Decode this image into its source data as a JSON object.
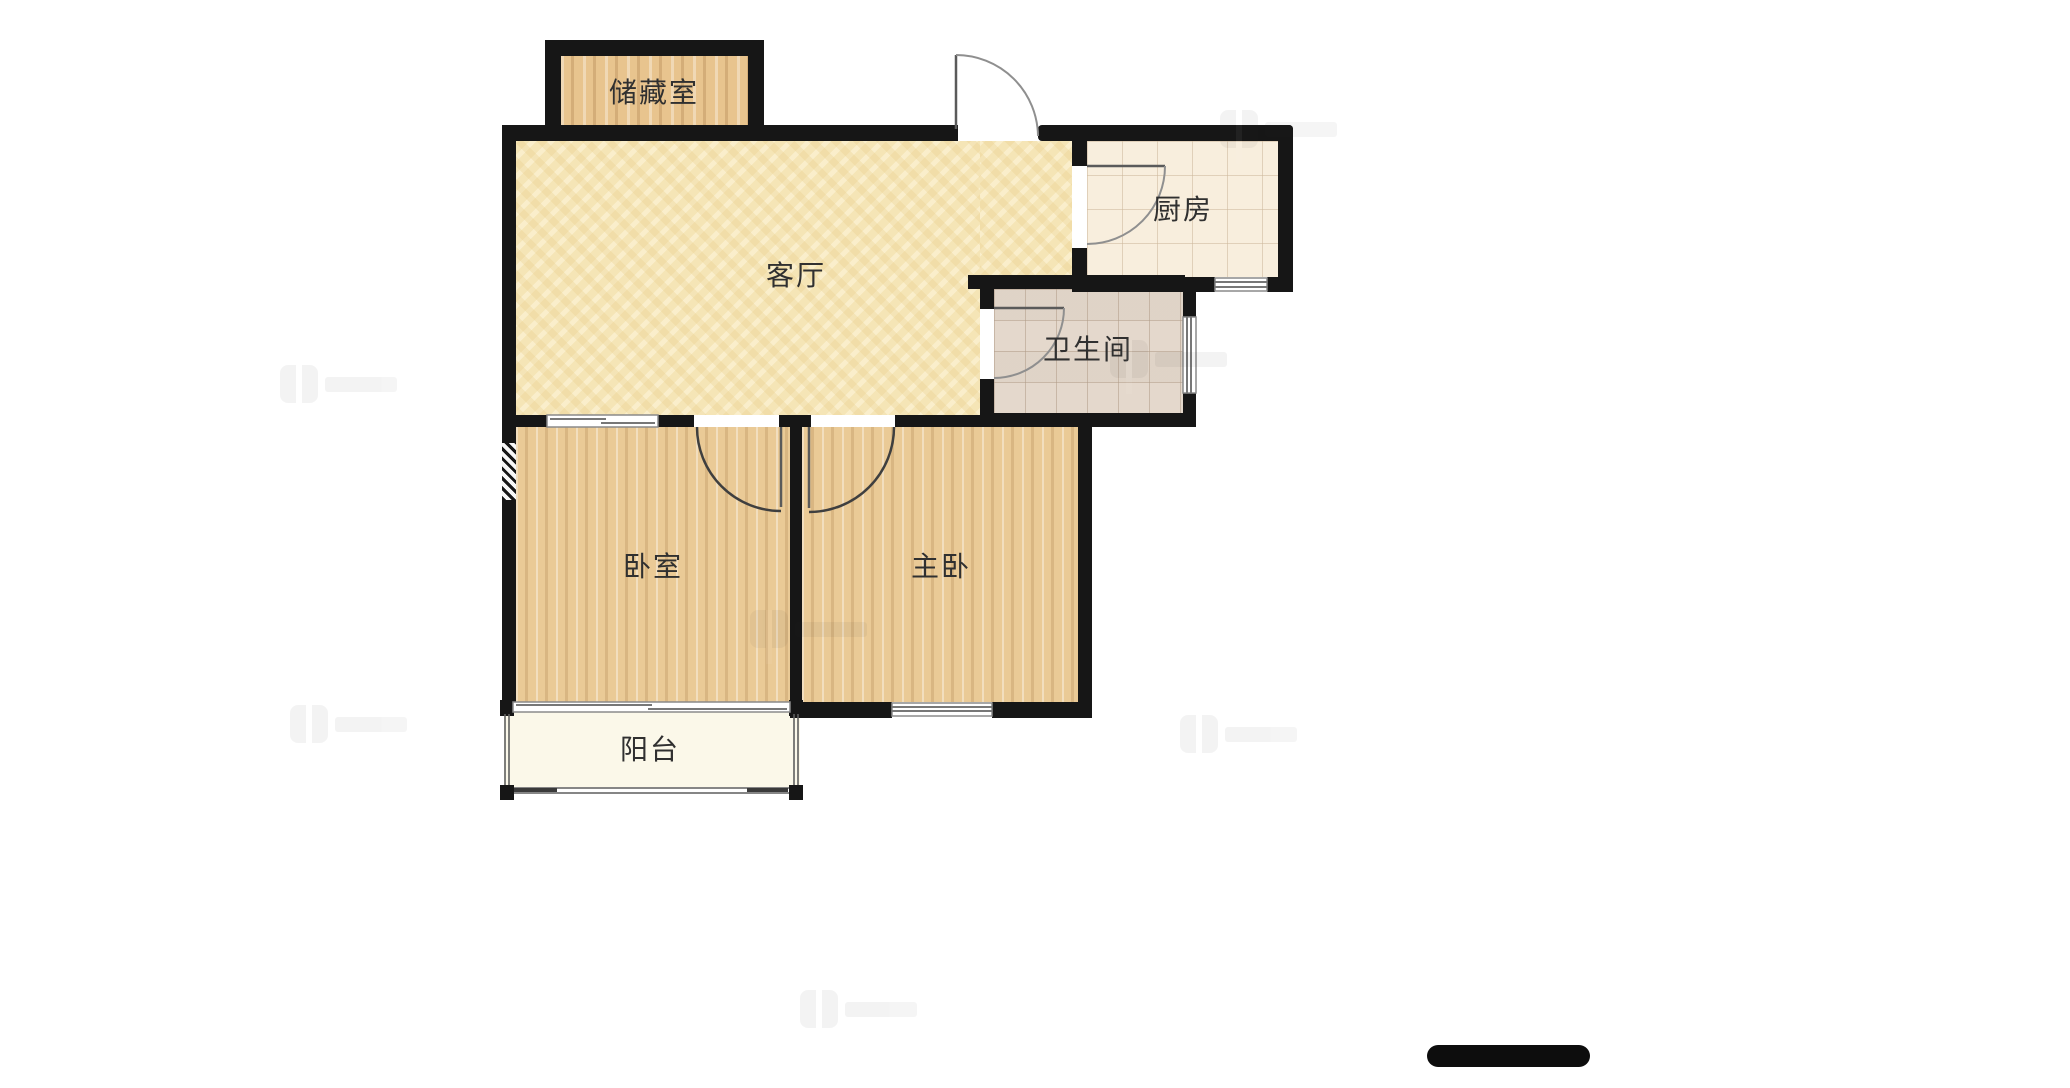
{
  "floor_plan": {
    "rooms": {
      "storage": {
        "label": "储藏室"
      },
      "living": {
        "label": "客厅"
      },
      "kitchen": {
        "label": "厨房"
      },
      "bathroom": {
        "label": "卫生间"
      },
      "bedroom": {
        "label": "卧室"
      },
      "master_bedroom": {
        "label": "主卧"
      },
      "balcony": {
        "label": "阳台"
      }
    },
    "colors": {
      "wall": "#161616",
      "living_floor": "#f5e5b6",
      "bedroom_wood_floor": "#eaca96",
      "storage_floor": "#e8c48e",
      "kitchen_tile_floor": "#f8eedd",
      "bathroom_tile_floor": "#ebe0d4",
      "balcony_floor": "#fbf8e9",
      "label_text": "#303030",
      "door_arc": "#8f8f8f",
      "window_symbol": "#777777",
      "scale_bar": "#0d0d0d",
      "background": "#ffffff"
    }
  }
}
